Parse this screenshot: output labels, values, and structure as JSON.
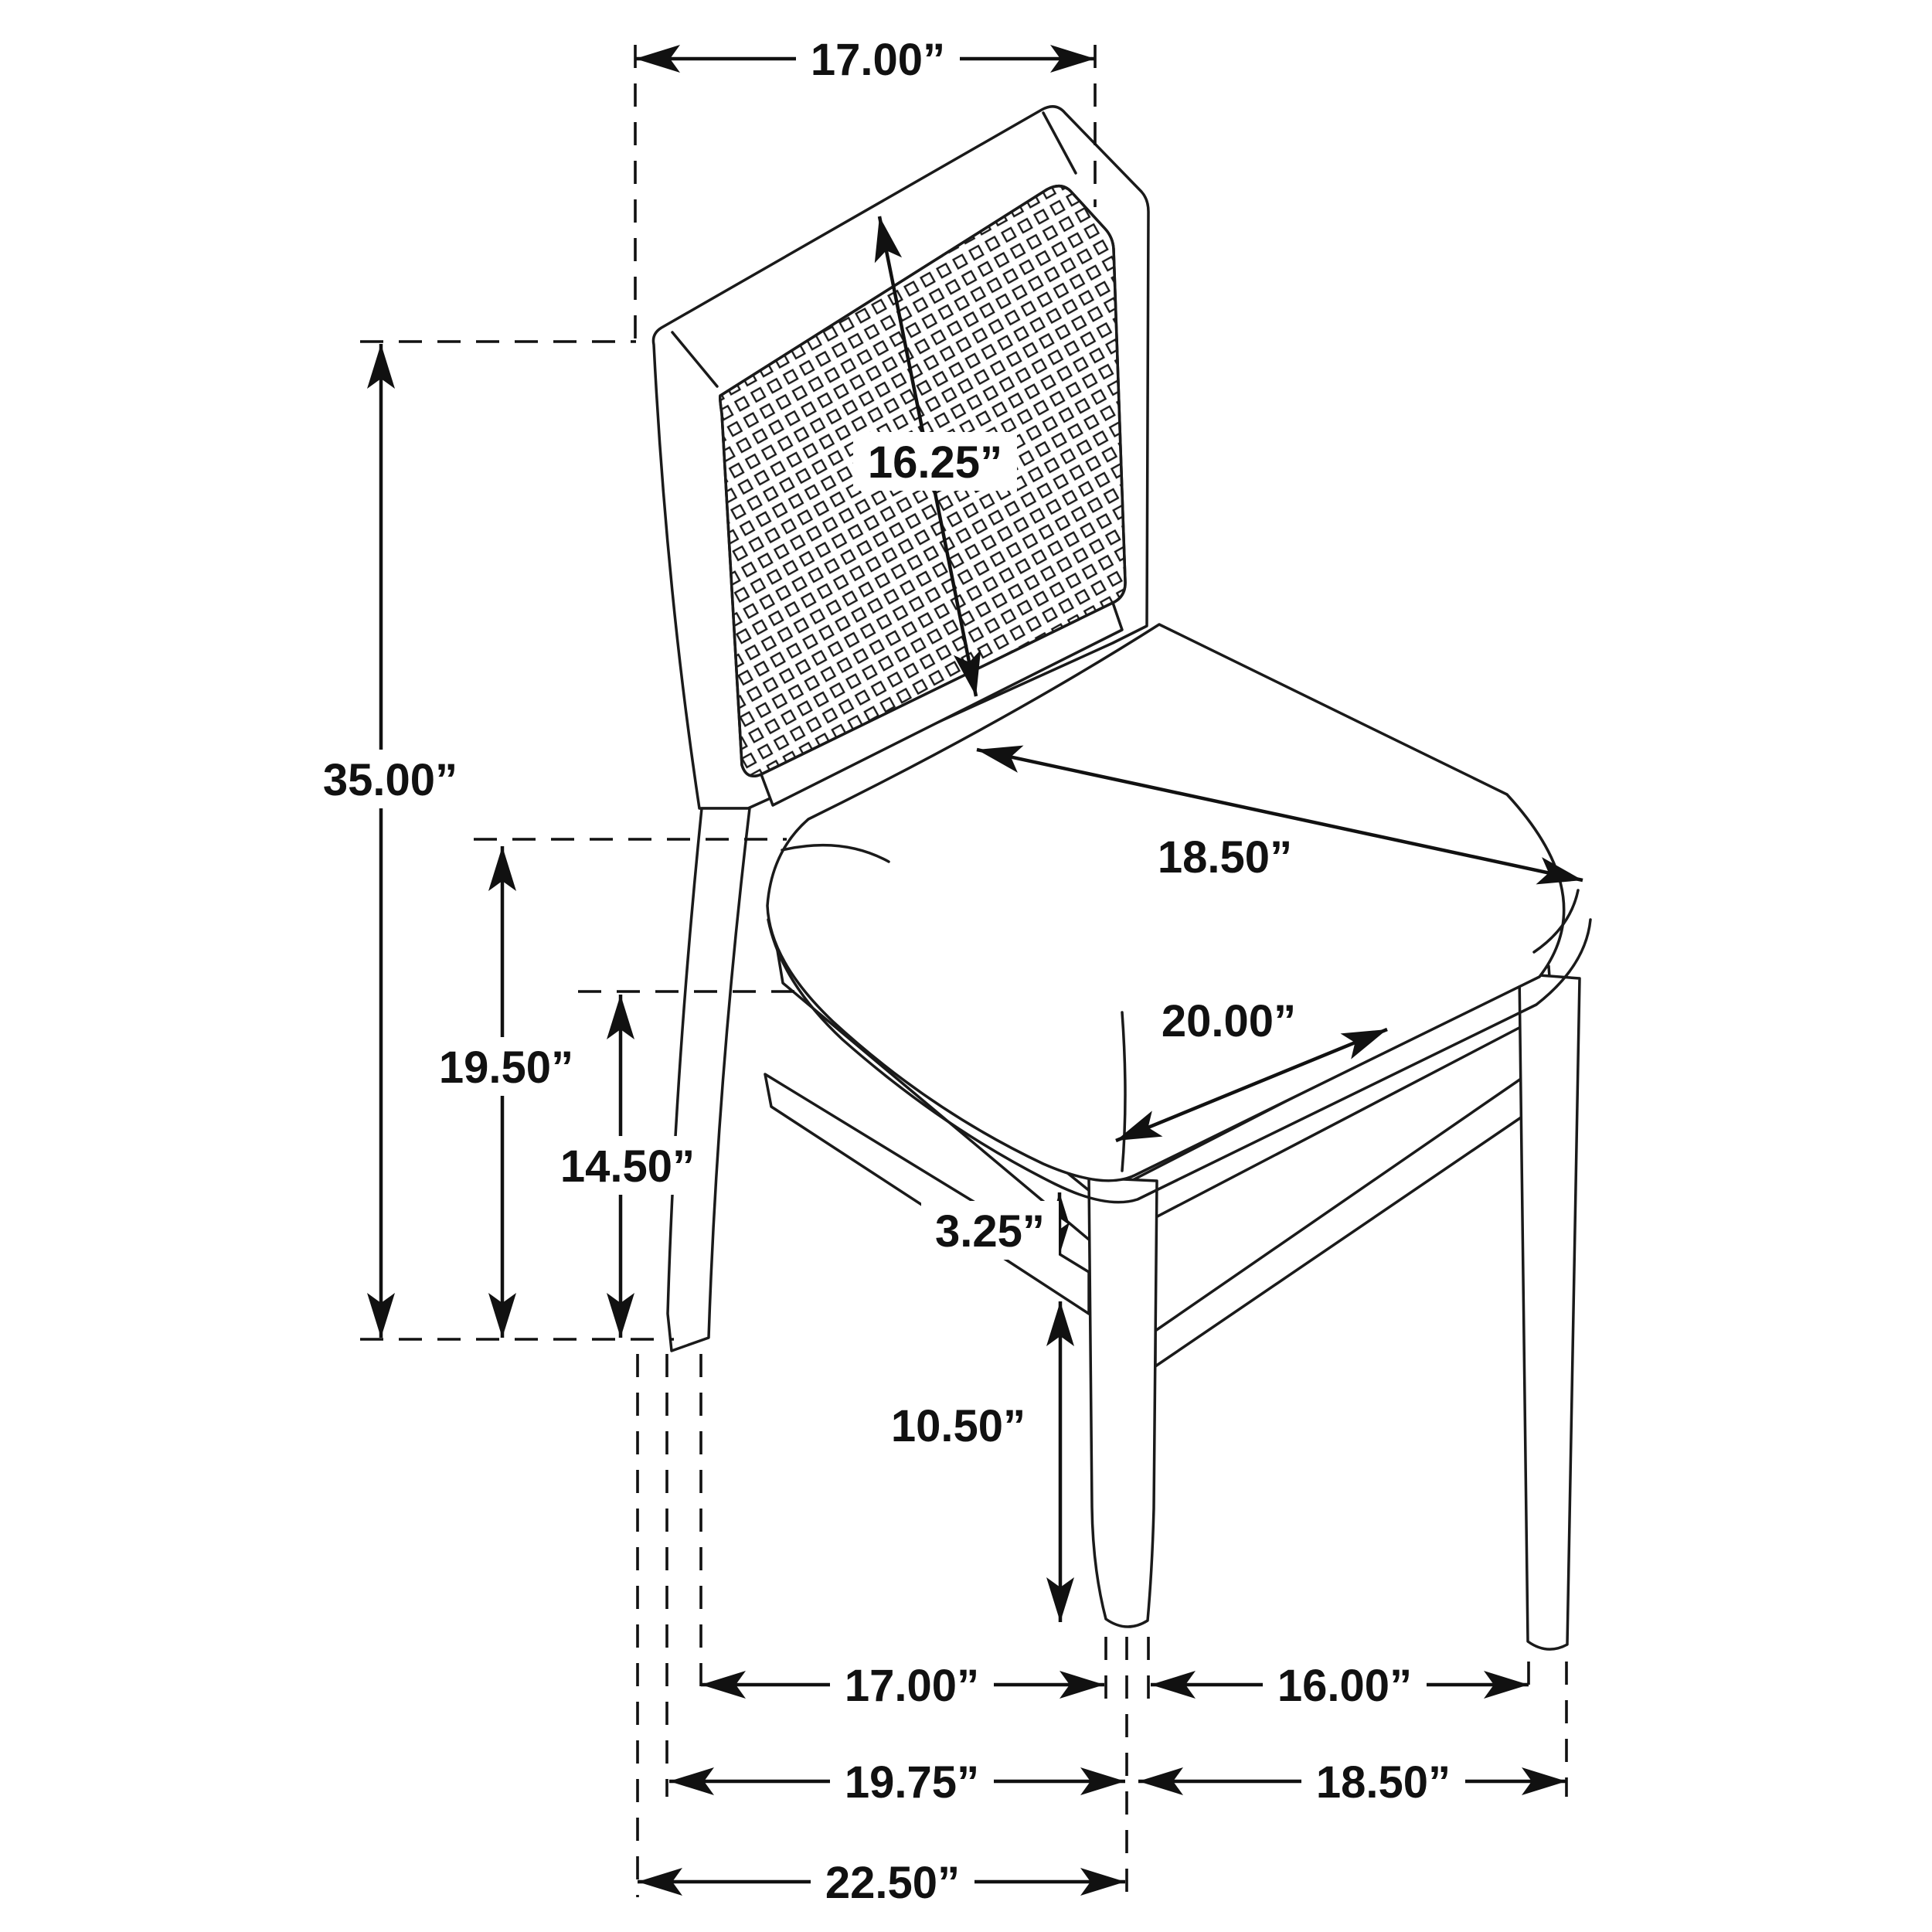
{
  "figure": {
    "kind": "furniture dimension diagram",
    "subject": "dining side chair with cane back panel and upholstered seat",
    "style": "black and white line art with dashed extension lines and arrow dimensions",
    "unit": "inches",
    "line_color": "#1a1a1a",
    "background_color": "#ffffff"
  },
  "dims": {
    "back_top_width": {
      "label": "17.00”",
      "inches": 17.0,
      "measures": "width across top of chair back"
    },
    "back_panel": {
      "label": "16.25”",
      "inches": 16.25,
      "measures": "cane back panel height (diagonal callout)"
    },
    "overall_height": {
      "label": "35.00”",
      "inches": 35.0,
      "measures": "overall height, floor to top of back"
    },
    "seat_height": {
      "label": "19.50”",
      "inches": 19.5,
      "measures": "floor to top of seat"
    },
    "rail_height": {
      "label": "14.50”",
      "inches": 14.5,
      "measures": "floor to bottom of seat rail"
    },
    "seat_depth": {
      "label": "18.50”",
      "inches": 18.5,
      "measures": "seat cushion depth"
    },
    "seat_width": {
      "label": "20.00”",
      "inches": 20.0,
      "measures": "seat cushion width"
    },
    "rail_stretcher_gap": {
      "label": "3.25”",
      "inches": 3.25,
      "measures": "gap between seat rail and side stretcher"
    },
    "stretcher_clearance": {
      "label": "10.50”",
      "inches": 10.5,
      "measures": "floor to underside of stretcher"
    },
    "leg_gap_side": {
      "label": "17.00”",
      "inches": 17.0,
      "measures": "clearance between back and front leg"
    },
    "leg_gap_front": {
      "label": "16.00”",
      "inches": 16.0,
      "measures": "clearance between front legs"
    },
    "leg_centers_side": {
      "label": "19.75”",
      "inches": 19.75,
      "measures": "back leg to front leg center distance"
    },
    "leg_centers_front": {
      "label": "18.50”",
      "inches": 18.5,
      "measures": "front leg center to center distance"
    },
    "overall_depth": {
      "label": "22.50”",
      "inches": 22.5,
      "measures": "overall depth of chair"
    }
  }
}
